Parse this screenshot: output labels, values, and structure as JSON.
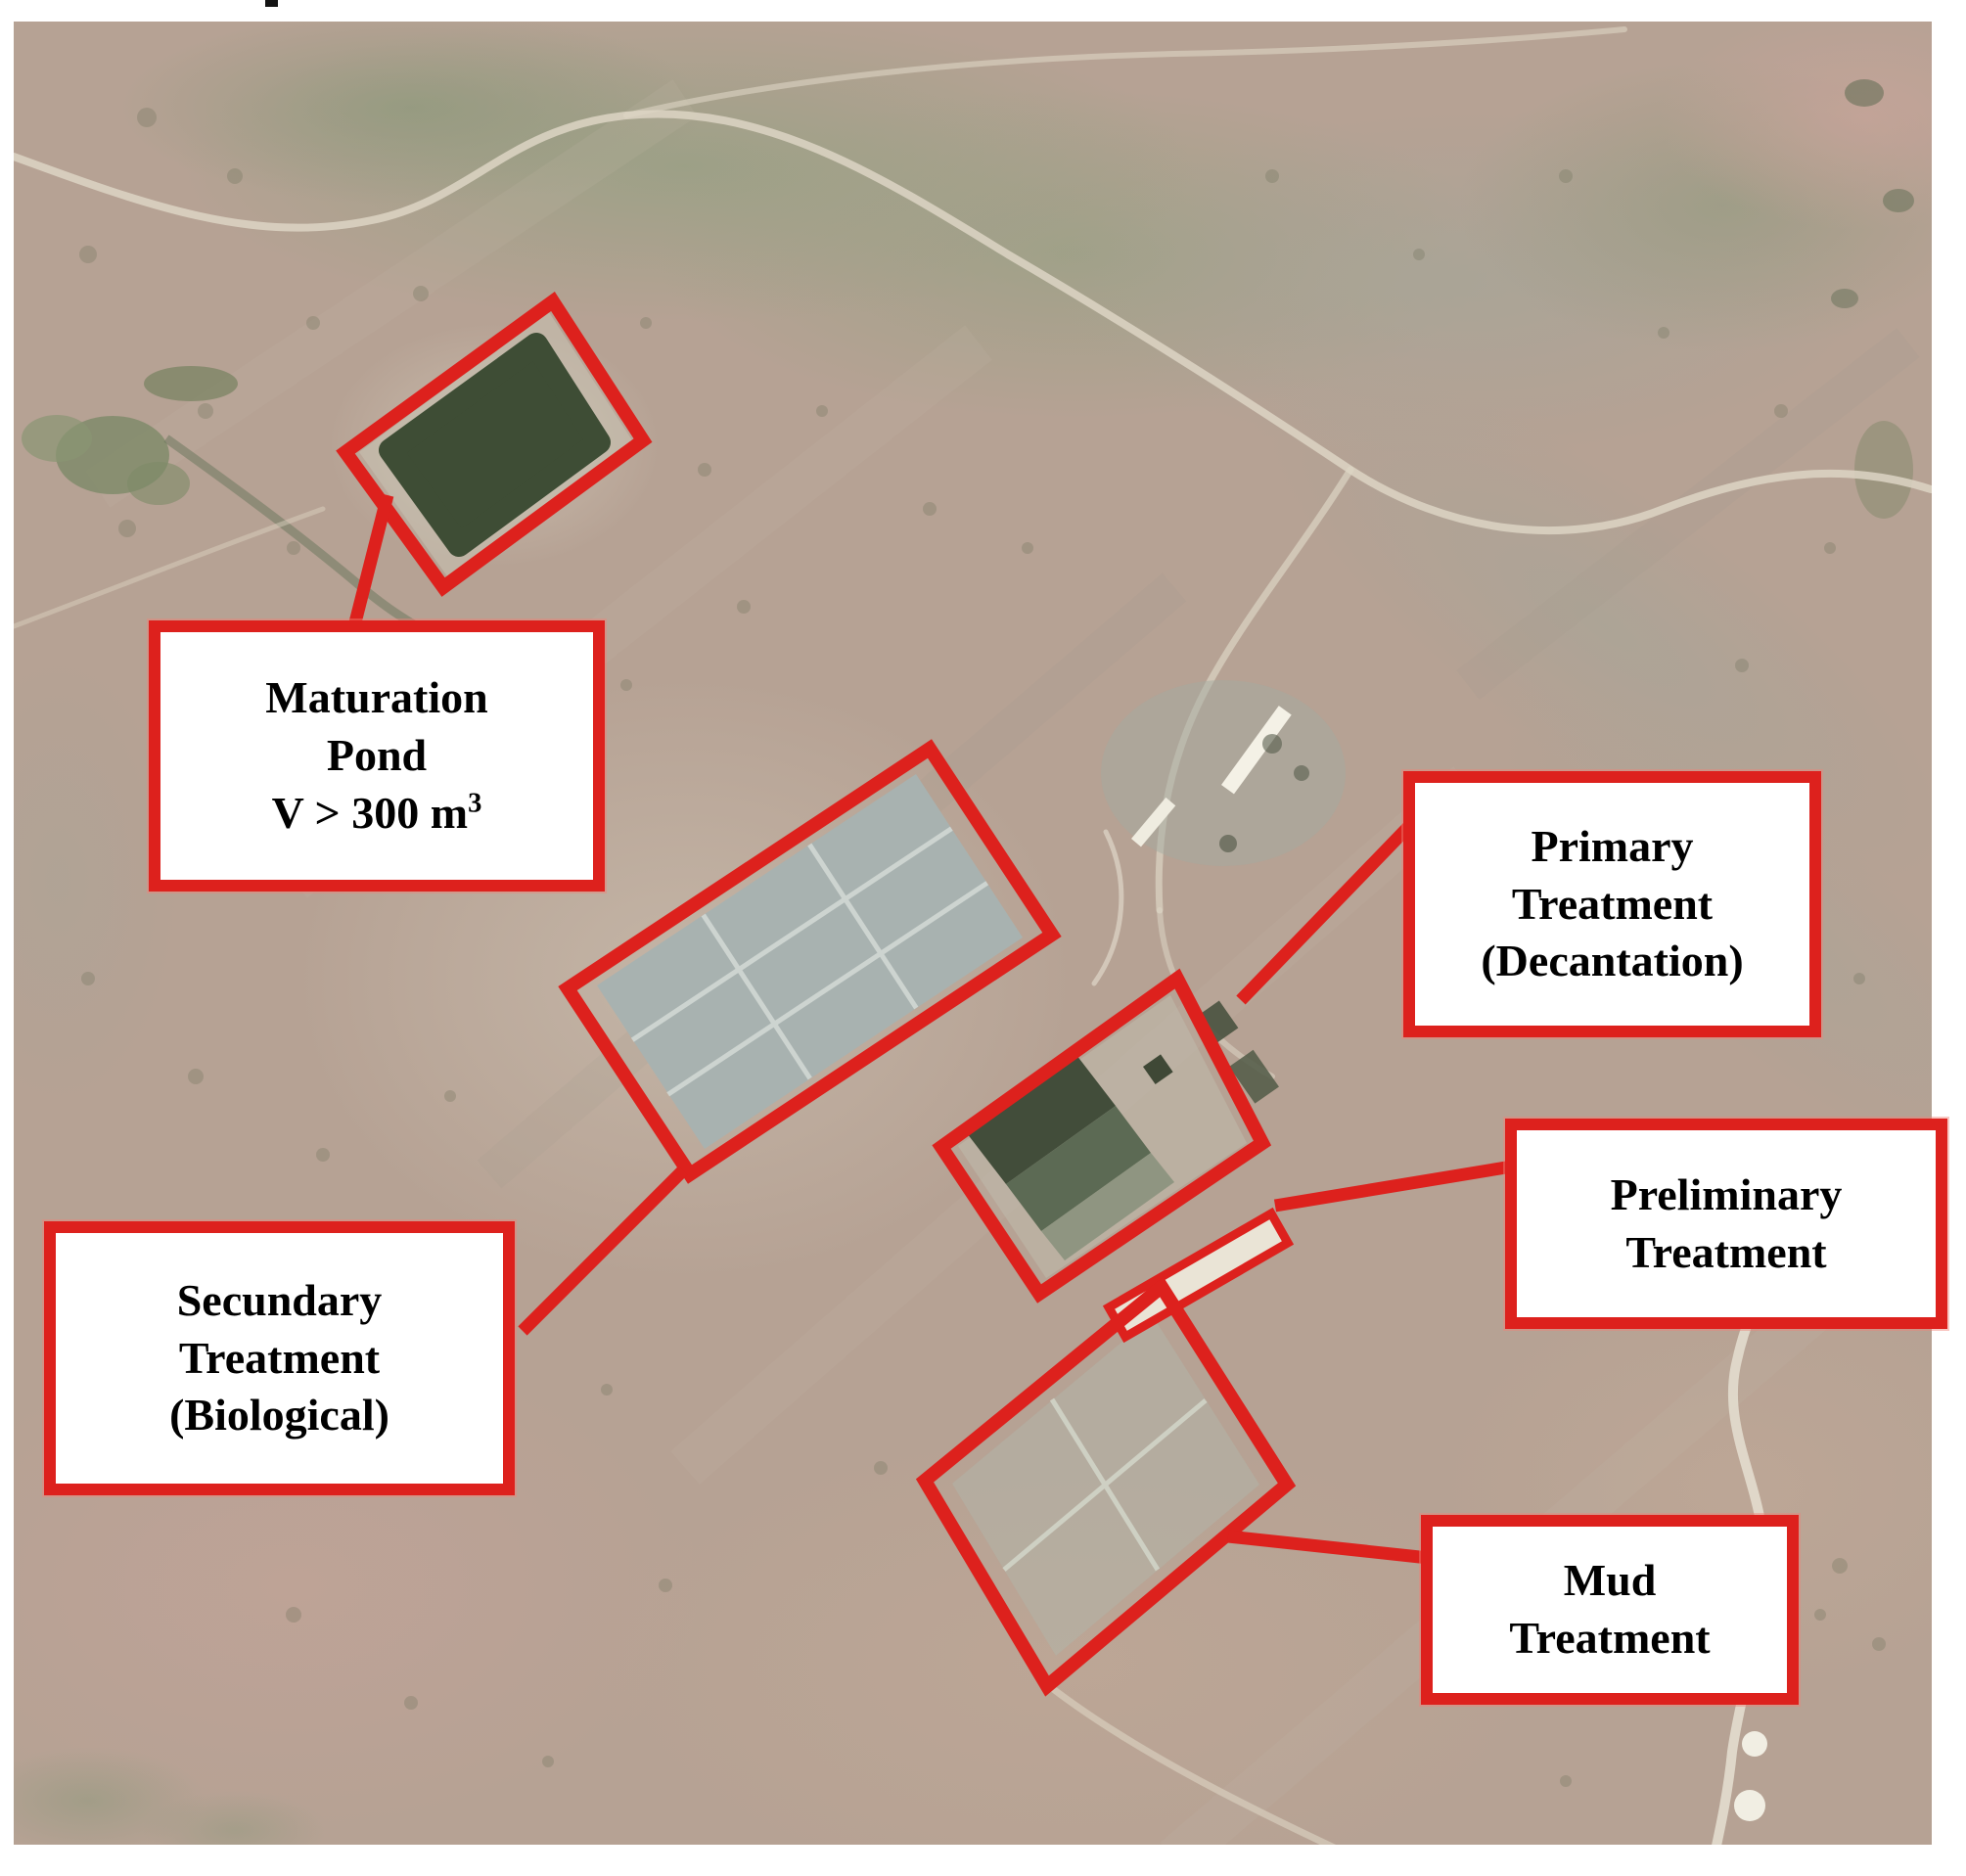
{
  "colors": {
    "annotation_red": "#dd211d",
    "label_background": "#ffffff",
    "label_text": "#000000",
    "pond_water": "#3e4d35",
    "basin_gray": "#a8b2b0",
    "terrain_tan": "#b6a294"
  },
  "labels": {
    "maturation": {
      "line1": "Maturation",
      "line2": "Pond",
      "volume_base": "V > 300 m",
      "volume_exponent": "3"
    },
    "primary": {
      "line1": "Primary",
      "line2": "Treatment",
      "line3": "(Decantation)"
    },
    "preliminary": {
      "line1": "Preliminary",
      "line2": "Treatment"
    },
    "secundary": {
      "line1": "Secundary",
      "line2": "Treatment",
      "line3": "(Biological)"
    },
    "mud": {
      "line1": "Mud",
      "line2": "Treatment"
    }
  }
}
